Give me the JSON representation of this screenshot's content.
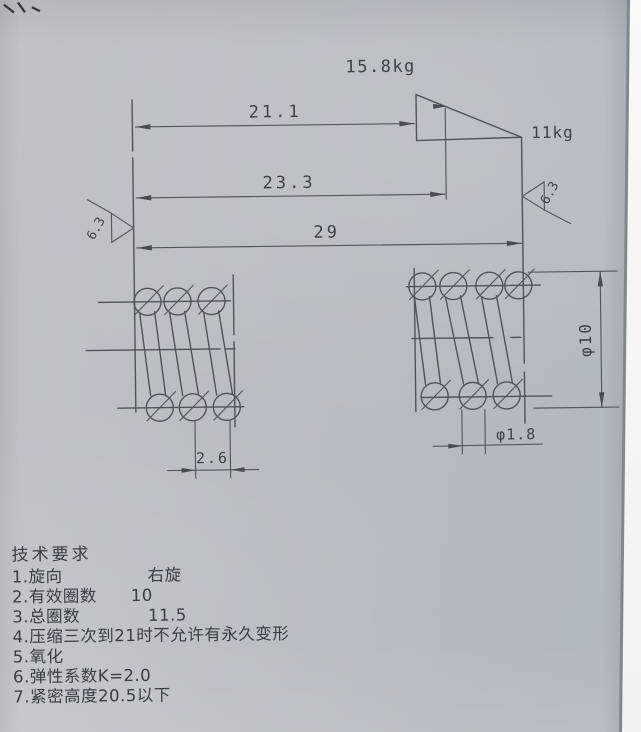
{
  "colors": {
    "paper": "#b8bdc3",
    "ink": "#4e545b",
    "text": "#3d4249",
    "photo_margin": "#f5f5f2",
    "paper_edge_line": "#83878c"
  },
  "load_diagram": {
    "upper_load": "15.8kg",
    "lower_load": "11kg"
  },
  "dimensions": {
    "length_at_upper_load": "21.1",
    "length_at_lower_load": "23.3",
    "free_length": "29",
    "coil_pitch": "2.6",
    "outer_diameter": "φ10",
    "wire_diameter": "φ1.8"
  },
  "surface_roughness": {
    "left": "6.3",
    "right": "6.3"
  },
  "tech_requirements": {
    "title": "技术要求",
    "items": [
      "1.旋向　　　　　右旋",
      "2.有效圈数　　10",
      "3.总圈数　　　　11.5",
      "4.压缩三次到21时不允许有永久变形",
      "5.氧化",
      "6.弹性系数K=2.0",
      "7.紧密高度20.5以下"
    ]
  }
}
